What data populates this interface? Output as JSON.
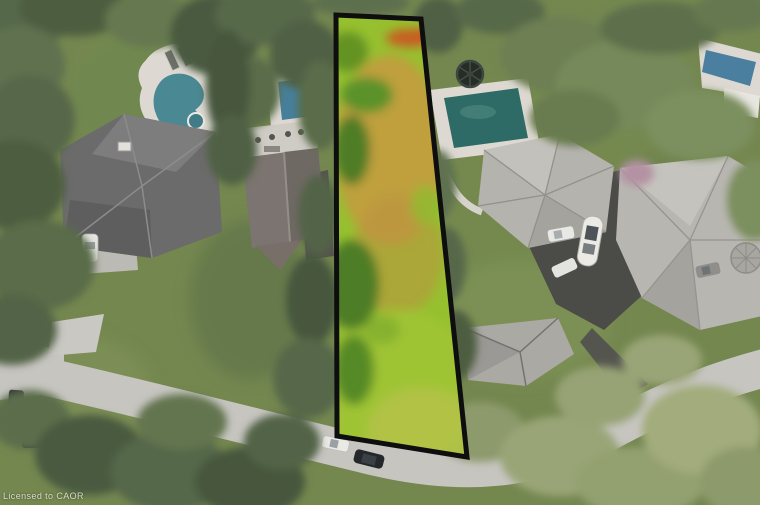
{
  "scene": {
    "kind": "aerial-drone-photo",
    "subject": "Residential neighbourhood with a vacant grass lot highlighted by a black boundary outline"
  },
  "watermark": {
    "text": "Licensed to CAOR"
  },
  "colors": {
    "lawn": "#74874f",
    "road": "#c6c5c0",
    "asphalt": "#4b4b48",
    "deck": "#ddd9d2",
    "roof_dark": "#6b6b6b",
    "roof_brown": "#7b7470",
    "roof_light": "#b5b3ae",
    "pool_kidney": "#4a8893",
    "pool_blue": "#467f9b",
    "pool_teal": "#2f6b66",
    "pool_topright": "#4a7fa0",
    "lot_grass": "#96c02f",
    "lot_grass_tan": "#c59a40",
    "lot_grass_orange": "#c75d22",
    "lot_outline": "#0e0e0e"
  },
  "visible_features": [
    "highlighted-vacant-lot",
    "kidney-pool",
    "rect-pool-left",
    "rect-pool-right",
    "pool-top-right",
    "trampoline",
    "boat-on-trailer",
    "house-left",
    "house-middle-left",
    "house-right",
    "house-far-right",
    "house-bottom",
    "curving-road",
    "asphalt-driveway",
    "parked-cars",
    "tree-canopy"
  ]
}
